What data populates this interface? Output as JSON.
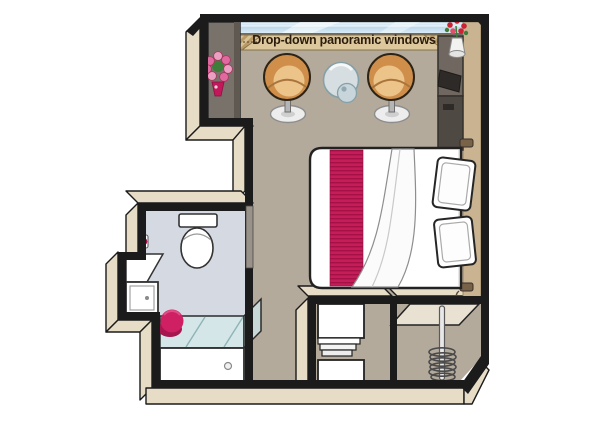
{
  "annotations": {
    "window_label": "Drop-down panoramic windows"
  },
  "palette": {
    "wall_outline": "#1b1b1b",
    "wall_face": "#e7dcc6",
    "floor": "#b3aa9c",
    "bath_floor": "#d5d9e1",
    "shower_glass": "#d3e7e9",
    "accent_red": "#c41d58",
    "stool_red": "#ce2063",
    "chair_orange": "#cf8f4b",
    "curtain_tan": "#dcc89c",
    "window_blue": "#c4def0",
    "cabinet_brown": "#6f6760",
    "wood_tan": "#c9b391",
    "label_text": "#2b1c0e"
  },
  "rooms": [
    {
      "name": "stateroom"
    },
    {
      "name": "bathroom"
    },
    {
      "name": "closet-shelves"
    },
    {
      "name": "wardrobe"
    }
  ],
  "furniture": [
    {
      "name": "double-bed"
    },
    {
      "name": "bed-runner"
    },
    {
      "name": "pillows"
    },
    {
      "name": "tub-chair-left"
    },
    {
      "name": "tub-chair-right"
    },
    {
      "name": "glass-table"
    },
    {
      "name": "tv-cabinet"
    },
    {
      "name": "dresser-counter"
    },
    {
      "name": "flower-bouquet"
    },
    {
      "name": "vase-with-flowers"
    },
    {
      "name": "curtains"
    },
    {
      "name": "panoramic-window"
    },
    {
      "name": "toilet"
    },
    {
      "name": "vanity-cabinet"
    },
    {
      "name": "shower"
    },
    {
      "name": "red-stool"
    },
    {
      "name": "shelf-stack"
    },
    {
      "name": "hanger-rod"
    },
    {
      "name": "reading-lights"
    },
    {
      "name": "bathroom-door"
    }
  ]
}
